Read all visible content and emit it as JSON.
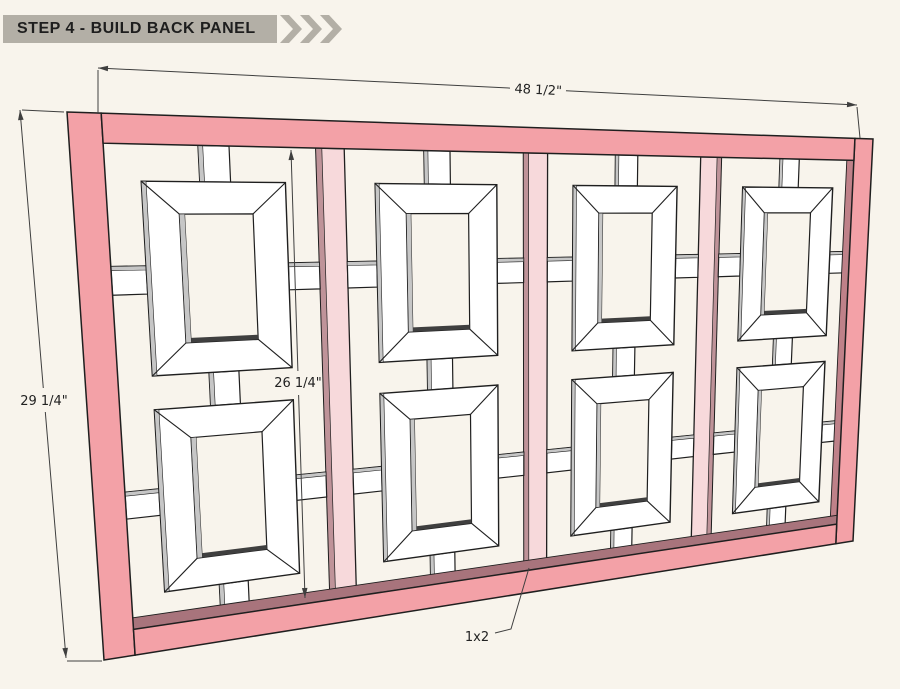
{
  "header": {
    "title": "STEP 4 - BUILD BACK PANEL"
  },
  "dimensions": {
    "width_label": "48 1/2\"",
    "height_label": "29 1/4\"",
    "opening_height_label": "26 1/4\"",
    "board_label": "1x2"
  },
  "diagram": {
    "description": "Back panel: pink 1x2 outer frame, three vertical 1x2 dividers, eight white mitered lattice frames joined by small connector blocks",
    "overall_width": "48 1/2\"",
    "overall_height": "29 1/4\"",
    "inner_opening_height": "26 1/4\"",
    "divider_board": "1x2",
    "columns": 4,
    "frames_per_column": 2
  },
  "colors": {
    "background": "#f8f4ec",
    "header_bar": "#b3afa6",
    "header_text": "#1e1e1e",
    "outline": "#1f1f1f",
    "frame_pink": "#f3a1a7",
    "stile_inner_face": "#bf8189",
    "rail_top_face": "#a8747c",
    "divider_pink": "#f7d9db",
    "divider_edge": "#bf9399",
    "wood_white": "#ffffff",
    "wood_gray": "#c6c6c6",
    "shadow_dark": "#3f3f3f",
    "dim_line": "#3f3f3f",
    "dim_text": "#222222"
  }
}
